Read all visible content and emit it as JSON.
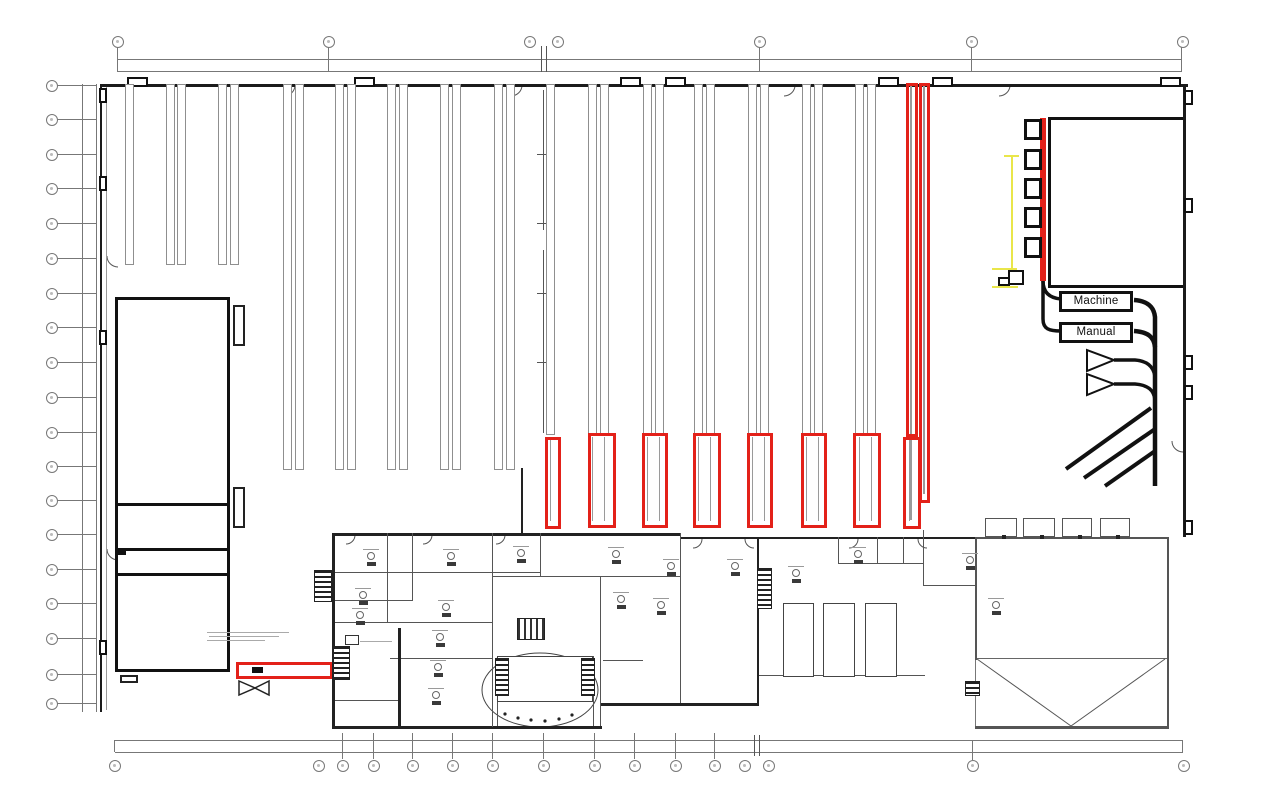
{
  "floorplan": {
    "flow_labels": {
      "machine": "Machine",
      "manual": "Manual"
    },
    "highlights": {
      "red_color": "#e32119",
      "yellow_color": "#e9e64a",
      "red_rack_end_boxes_count": 8,
      "red_vertical_lanes_count": 2,
      "red_dock_bar_count": 1
    },
    "grid_markers": {
      "top_count": 7,
      "left_count": 19,
      "bottom_count": 16
    }
  }
}
